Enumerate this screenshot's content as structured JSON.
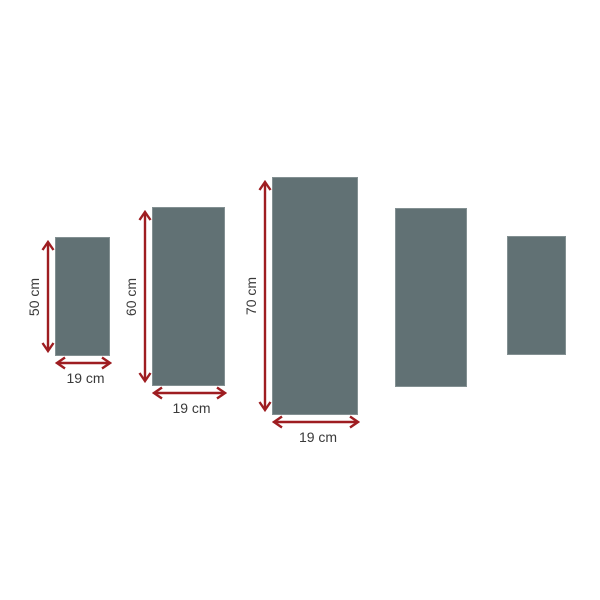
{
  "diagram": {
    "background_color": "#ffffff",
    "panel_color": "#617174",
    "arrow_color": "#9e1d21",
    "label_color": "#3a3a3a",
    "unit": "cm",
    "panels": [
      {
        "name": "panel-1",
        "annotated": true,
        "height_label": "50 cm",
        "width_label": "19 cm",
        "height_cm": 50,
        "width_cm": 19,
        "left": 55,
        "top": 237,
        "width": 55,
        "height": 119
      },
      {
        "name": "panel-2",
        "annotated": true,
        "height_label": "60 cm",
        "width_label": "19 cm",
        "height_cm": 60,
        "width_cm": 19,
        "left": 152,
        "top": 207,
        "width": 73,
        "height": 179
      },
      {
        "name": "panel-3",
        "annotated": true,
        "height_label": "70 cm",
        "width_label": "19 cm",
        "height_cm": 70,
        "width_cm": 19,
        "left": 272,
        "top": 177,
        "width": 86,
        "height": 238
      },
      {
        "name": "panel-4",
        "annotated": false,
        "left": 395,
        "top": 208,
        "width": 72,
        "height": 179
      },
      {
        "name": "panel-5",
        "annotated": false,
        "left": 507,
        "top": 236,
        "width": 59,
        "height": 119
      }
    ]
  }
}
